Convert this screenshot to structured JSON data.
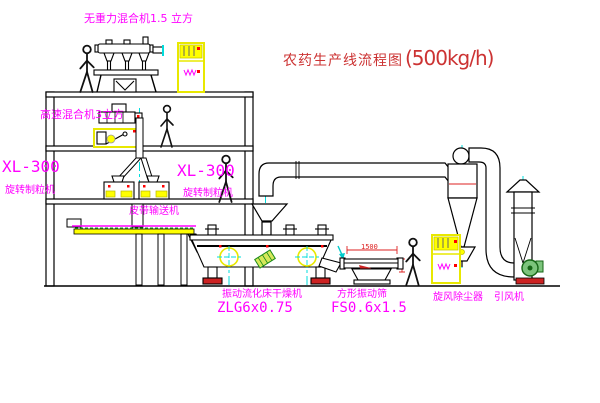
{
  "title": {
    "name": "农药生产线流程图",
    "capacity": "(500kg/h)"
  },
  "labels": {
    "top_mixer": "无重力混合机1.5 立方",
    "high_speed_mixer": "高速混合机3立方",
    "granulator_left": {
      "model": "XL-300",
      "name": "旋转制粒机"
    },
    "granulator_mid": {
      "model": "XL-300",
      "name": "旋转制粒机"
    },
    "belt_conveyor": "皮带输送机",
    "dryer": {
      "name": "振动流化床干燥机",
      "model": "ZLG6x0.75"
    },
    "screen": {
      "name": "方形振动筛",
      "model": "FS0.6x1.5"
    },
    "cyclone": "旋风除尘器",
    "fan": "引风机"
  },
  "dimensions": {
    "screen_width": "1500"
  },
  "colors": {
    "label": "#ff00ff",
    "title": "#cc3333",
    "equipment_accent": "#f0f000",
    "centerline": "#00dddd",
    "line": "#000000",
    "alert": "#dd2222",
    "green": "#1a8a1a"
  }
}
